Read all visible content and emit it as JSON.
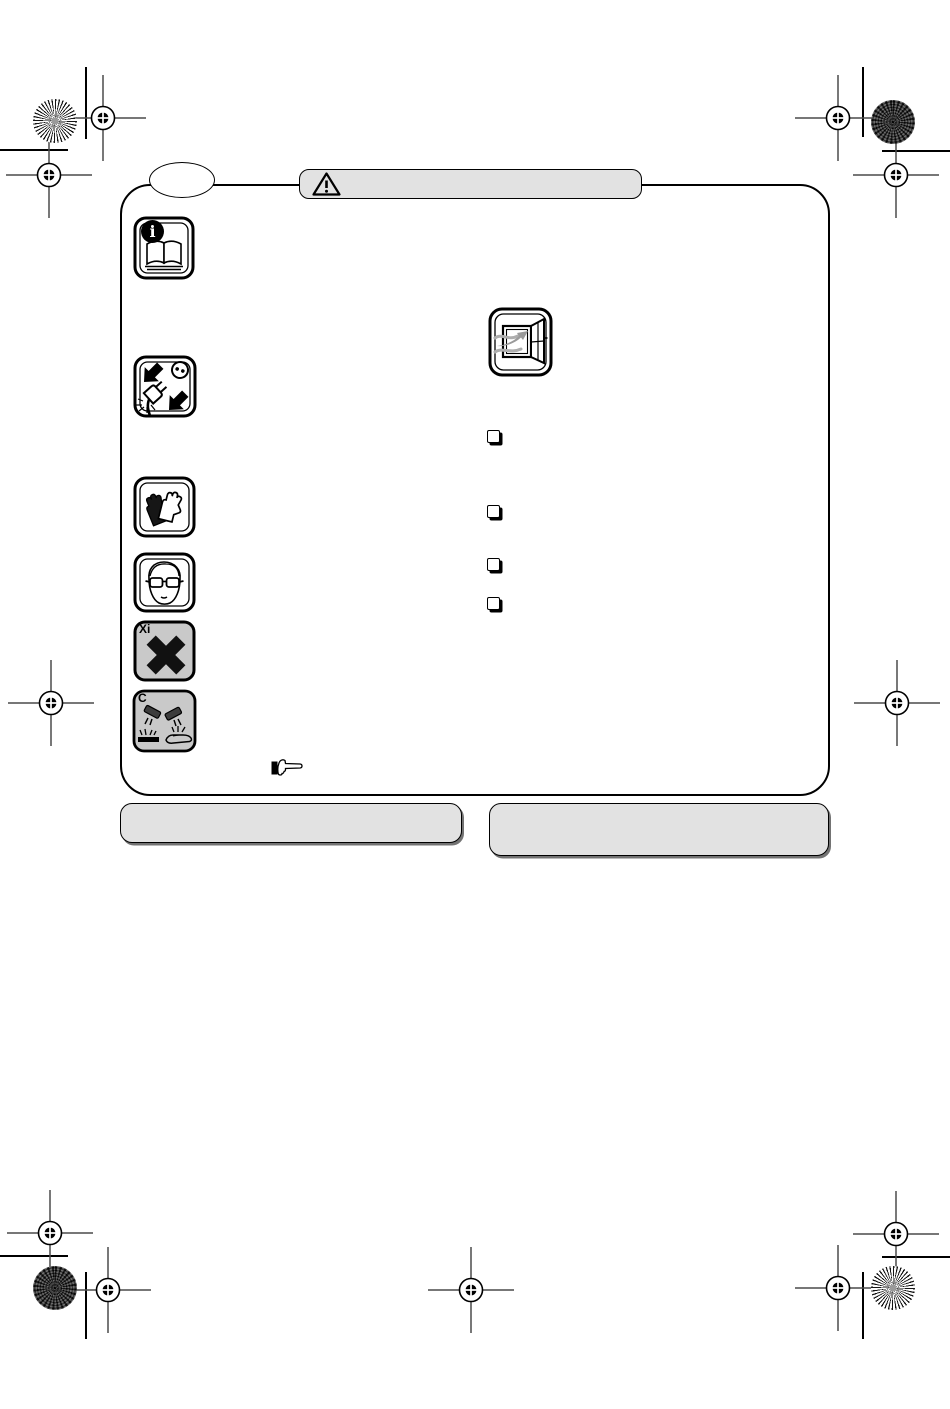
{
  "colors": {
    "paper": "#ffffff",
    "ink": "#000000",
    "band_fill": "#e2e2e2",
    "hazard_fill": "#c9c9c9",
    "airflow_gray": "#9a9a9a"
  },
  "title_band": {
    "icon": "warning-triangle-icon",
    "label": ""
  },
  "callout_oval": {
    "label": ""
  },
  "safety_column": {
    "icons": [
      {
        "name": "read-manual-icon",
        "badge": "i"
      },
      {
        "name": "unplug-before-service-icon"
      },
      {
        "name": "protective-gloves-icon"
      },
      {
        "name": "safety-goggles-icon"
      },
      {
        "name": "irritant-hazard-icon",
        "code": "Xi"
      },
      {
        "name": "corrosive-hazard-icon",
        "code": "C"
      }
    ]
  },
  "body": {
    "ventilation_icon": "open-window-airflow-icon",
    "checklist_bullet_count": 4,
    "note_pointer_icon": "pointing-hand-icon"
  },
  "footer_bands": {
    "left_label": "",
    "right_label": ""
  },
  "print_marks": {
    "registration_mark": "registration-target-icon",
    "registration_mark_count": 11,
    "corner_art_top_left": "sunburst-circle",
    "corner_art_top_right": "halftone-circle",
    "corner_art_bottom_left": "halftone-circle",
    "corner_art_bottom_right": "sunburst-circle"
  }
}
